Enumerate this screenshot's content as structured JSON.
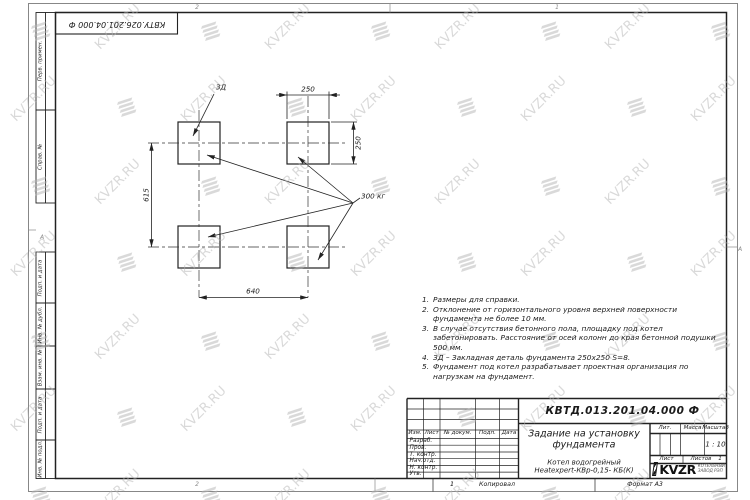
{
  "watermark": {
    "text": "KVZR.RU"
  },
  "stamp_top": {
    "text": "КВТУ.026.201.04.000 Ф"
  },
  "zones": {
    "top_left": "2",
    "top_right": "1",
    "bottom_left": "2",
    "bottom_right": "1",
    "left": "А",
    "right": "А"
  },
  "margin_fields": [
    {
      "label": "Перв. примен."
    },
    {
      "label": "Справ. №"
    },
    {
      "label": "Подп. и дата"
    },
    {
      "label": "Инв. № дубл."
    },
    {
      "label": "Взам. инв. №"
    },
    {
      "label": "Подп. и дата"
    },
    {
      "label": "Инв. № подл."
    }
  ],
  "drawing": {
    "label_zd": "ЗД",
    "label_load": "300 кг",
    "dim_top": "250",
    "dim_right": "250",
    "dim_left": "615",
    "dim_bottom": "640"
  },
  "notes": {
    "items": [
      {
        "num": "1.",
        "text": "Размеры для справки."
      },
      {
        "num": "2.",
        "text": "Отклонение от горизонтального уровня верхней поверхности фундамента не более 10 мм."
      },
      {
        "num": "3.",
        "text": "В случае отсутствия бетонного пола, площадку под котел забетонировать. Расстояние от осей колонн до края бетонной подушки 500 мм."
      },
      {
        "num": "4.",
        "text": "ЗД – Закладная деталь фундамента 250х250 S=8."
      },
      {
        "num": "5.",
        "text": "Фундамент под котел разрабатывает проектная организация по нагрузкам на фундамент."
      }
    ]
  },
  "title_block": {
    "doc_number": "КВТД.013.201.04.000 Ф",
    "title_line1": "Задание на установку",
    "title_line2": "фундамента",
    "product_line1": "Котел водогрейный",
    "product_line2": "Heatexpert-КВр-0,15- КБ(К)",
    "headers": {
      "izm": "Изм.",
      "list": "Лист",
      "doc": "№ докум.",
      "sign": "Подп.",
      "date": "Дата"
    },
    "rows": [
      "Разраб.",
      "Пров.",
      "Т. контр.",
      "Нач.отд.",
      "Н. контр.",
      "Утв."
    ],
    "lit_label": "Лит.",
    "mass_label": "Масса",
    "scale_label": "Масштаб",
    "scale_value": "1 : 10",
    "sheet_label": "Лист",
    "sheets_label": "Листов",
    "sheets_value": "1",
    "logo": {
      "name": "KVZR",
      "sub1": "КОТЕЛЬНЫЙ",
      "sub2": "ЗАВОД РЭП"
    }
  },
  "footer": {
    "zone": "1",
    "copied": "Копировал",
    "format": "Формат А3"
  }
}
